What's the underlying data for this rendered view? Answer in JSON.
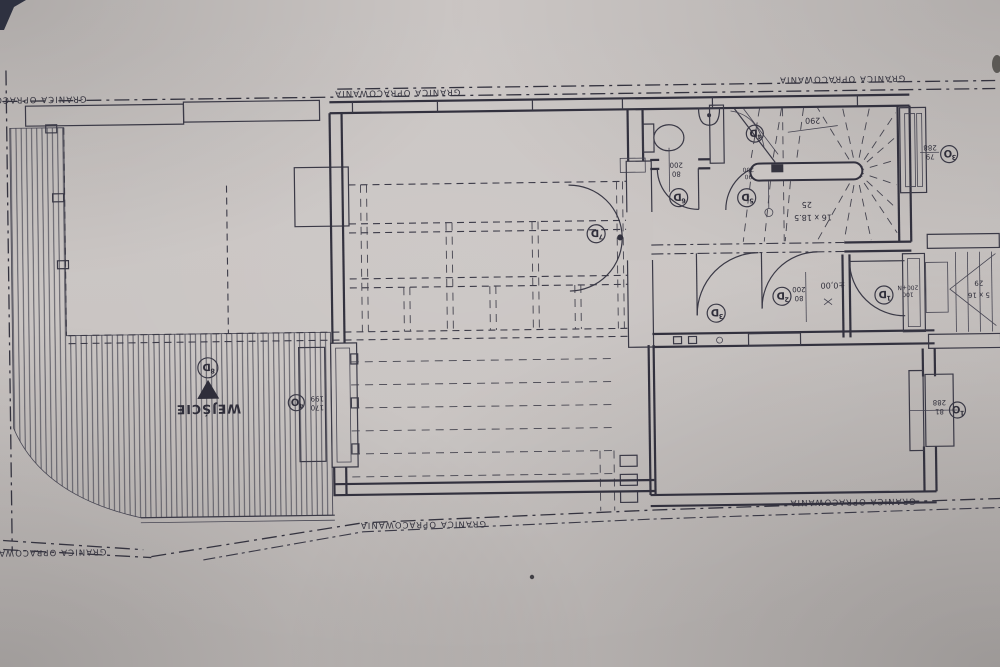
{
  "plan": {
    "boundary": {
      "label": "GRANICA OPRACOWANIA"
    },
    "entrance": {
      "label": "WEJŚCIE"
    },
    "level_mark": "±0,00",
    "doors": {
      "d1": {
        "letter": "D",
        "sub": "1",
        "dim_w": "100",
        "dim_h": "200+N"
      },
      "d2": {
        "letter": "D",
        "sub": "2",
        "dim_w": "80",
        "dim_h": "200"
      },
      "d3": {
        "letter": "D",
        "sub": "3"
      },
      "d4": {
        "letter": "D",
        "sub": "4",
        "dim_w": "90",
        "dim_h": "200"
      },
      "d5": {
        "letter": "D",
        "sub": "5"
      },
      "d6": {
        "letter": "D",
        "sub": "6",
        "dim_w": "80",
        "dim_h": "200"
      },
      "d7": {
        "letter": "D",
        "sub": "7"
      },
      "d8": {
        "letter": "D",
        "sub": "8"
      }
    },
    "windows": {
      "o1": {
        "letter": "O",
        "sub": "1",
        "dim_w": "81",
        "dim_h": "288"
      },
      "o3": {
        "letter": "O",
        "sub": "3",
        "dim_w": "79",
        "dim_h": "288"
      },
      "o4": {
        "letter": "O",
        "sub": "4",
        "dim_w": "170",
        "dim_h": "199"
      }
    },
    "stairs": {
      "main": {
        "width": "290",
        "going": "25",
        "treads": "16 x 18.5"
      },
      "exterior": {
        "rise": "29",
        "treads": "5 x 16"
      }
    }
  }
}
